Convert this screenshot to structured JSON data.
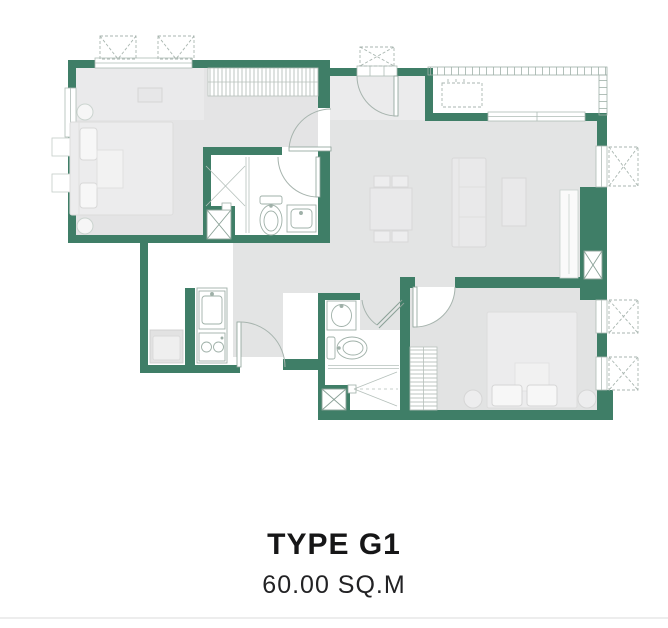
{
  "title": "TYPE G1",
  "area": "60.00 SQ.M",
  "colors": {
    "wall_green": "#3F7E67",
    "floor_gray": "#E3E4E4",
    "floor_light": "#EBEBEC",
    "fixture_line": "#9FB0A8",
    "dashed_line": "#A9B6B0",
    "hatch_line": "#B7C0BB",
    "text_dark": "#1C1C1E"
  },
  "plan": {
    "rooms": [
      "bedroom-1",
      "bathroom-1",
      "living-dining",
      "balcony",
      "entrance-hall",
      "kitchen",
      "bathroom-2",
      "bedroom-2"
    ],
    "fixtures": [
      "double-bed",
      "nightstands",
      "tv-cabinet",
      "wardrobe-hatched",
      "shower",
      "toilet",
      "sink-vanity",
      "dining-table-4-chairs",
      "sofa",
      "kitchen-sink",
      "two-burner-stove",
      "washing-machine",
      "tall-cabinet",
      "balcony-bench"
    ],
    "symbols": [
      "ac-condenser-dashed-box",
      "service-shaft-x-box",
      "door-swing-arc",
      "window-opening",
      "balcony-railing-ticks"
    ]
  }
}
